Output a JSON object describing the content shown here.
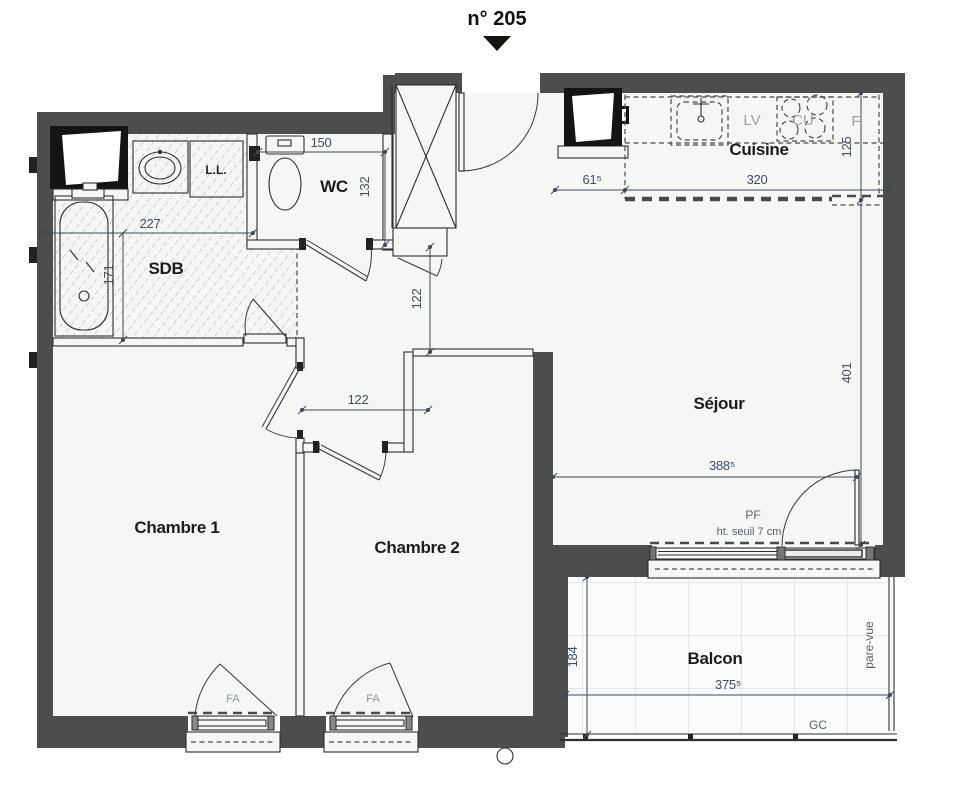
{
  "title": {
    "number": "n° 205"
  },
  "rooms": {
    "sdb": "SDB",
    "wc": "WC",
    "cuisine": "Cuisine",
    "sejour": "Séjour",
    "chambre1": "Chambre 1",
    "chambre2": "Chambre 2",
    "balcon": "Balcon"
  },
  "fixtures": {
    "washing_machine": "L.L."
  },
  "kitchen": {
    "dishwasher": "LV",
    "cooktop": "CU",
    "fridge": "F"
  },
  "windows": {
    "fa": "FA",
    "pf": "PF",
    "pf_note": "ht. seuil  7 cm",
    "pare_vue": "pare-vue",
    "gc": "GC"
  },
  "dims": {
    "wc_width": "150",
    "wc_depth": "132",
    "sdb_width": "227",
    "sdb_depth": "171",
    "hall_depth": "122",
    "hall_width": "122",
    "kitchen_offset": "61⁵",
    "kitchen_width": "320",
    "kitchen_depth": "125",
    "sejour_length": "401",
    "sejour_width": "388⁵",
    "balcony_depth": "184",
    "balcony_width": "375⁵"
  },
  "colors": {
    "wall": "#4d4d4d",
    "dimension_text": "#3e5062",
    "room_label": "#1c1c1c",
    "appliance_label": "#98a5ae"
  }
}
